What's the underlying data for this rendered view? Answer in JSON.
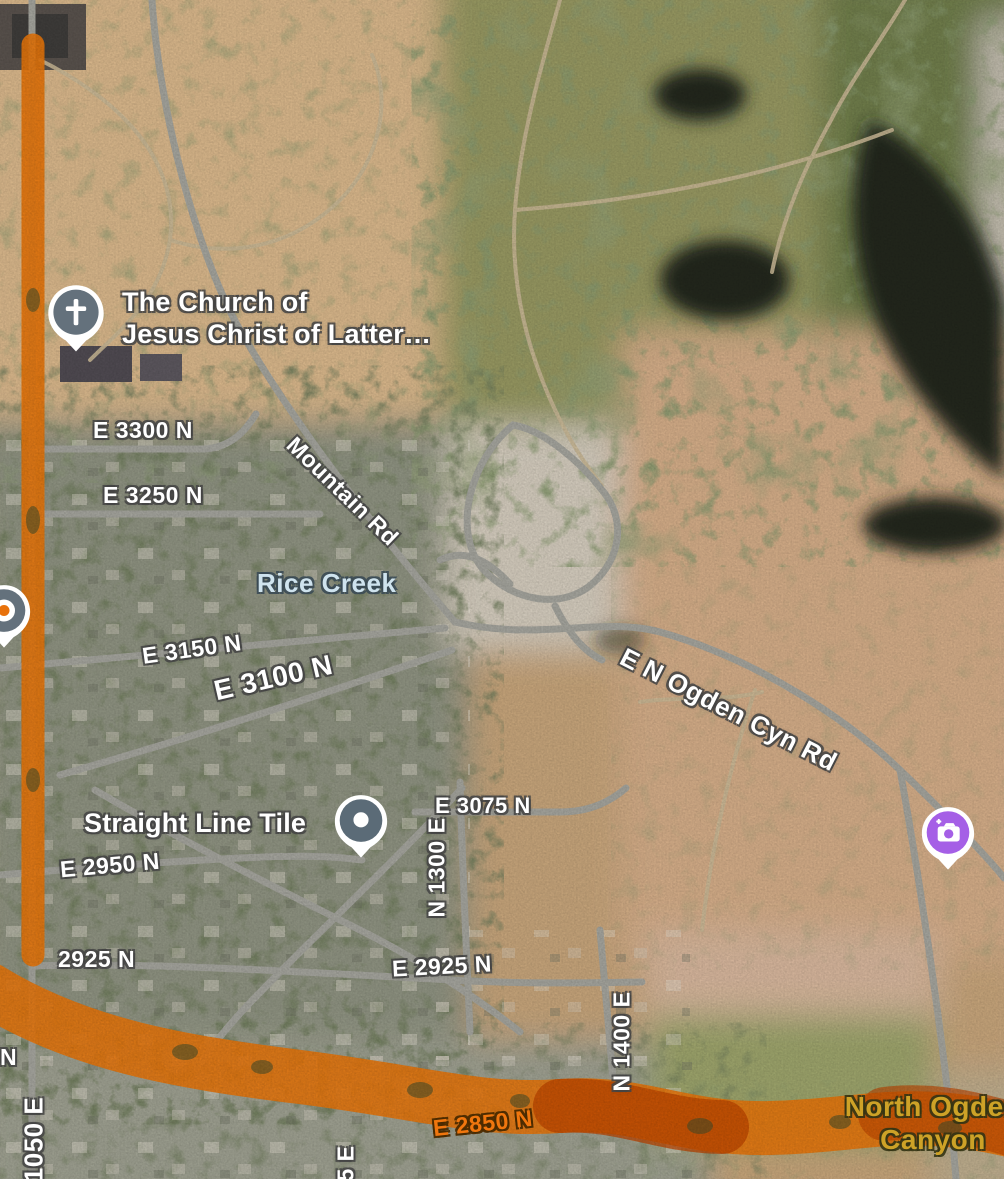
{
  "map": {
    "view_mode": "satellite-with-traffic",
    "pois": {
      "church": {
        "line1": "The Church of",
        "line2": "Jesus Christ of Latter…",
        "icon": "church-cross"
      },
      "straight_line_tile": {
        "label": "Straight Line Tile",
        "icon": "place-dot"
      },
      "photo_spot": {
        "icon": "camera-plus"
      },
      "left_edge_place": {
        "icon": "place-dot-orange"
      }
    },
    "water_labels": {
      "rice_creek": "Rice Creek"
    },
    "area_labels": {
      "north_ogden_canyon_line1": "North Ogden",
      "north_ogden_canyon_line2": "Canyon"
    },
    "road_labels": {
      "e_3300_n": "E 3300 N",
      "e_3250_n": "E 3250 N",
      "mountain_rd": "Mountain Rd",
      "e_3150_n": "E 3150 N",
      "e_3100_n": "E 3100 N",
      "e_n_ogden_cyn_rd": "E N Ogden Cyn Rd",
      "e_3075_n": "E 3075 N",
      "n_1300_e": "N 1300 E",
      "e_2950_n": "E 2950 N",
      "n_2925": "2925 N",
      "e_2925_n": "E 2925 N",
      "n_1400_e": "N 1400 E",
      "e_2850_n": "E 2850 N",
      "n_1050_e": "1050 E",
      "fragment_n": "N",
      "fragment_5e": "5 E"
    },
    "colors": {
      "traffic_heavy": "#e0720b",
      "traffic_severe": "#b84300",
      "traffic_label": "#f0760e",
      "water_label": "#cfe3ee",
      "canyon_label": "#cda227",
      "road_gray": "#a0a099",
      "church_pin": "#64717c",
      "business_pin": "#5b6b77",
      "camera_pin": "#a55fe6"
    }
  }
}
